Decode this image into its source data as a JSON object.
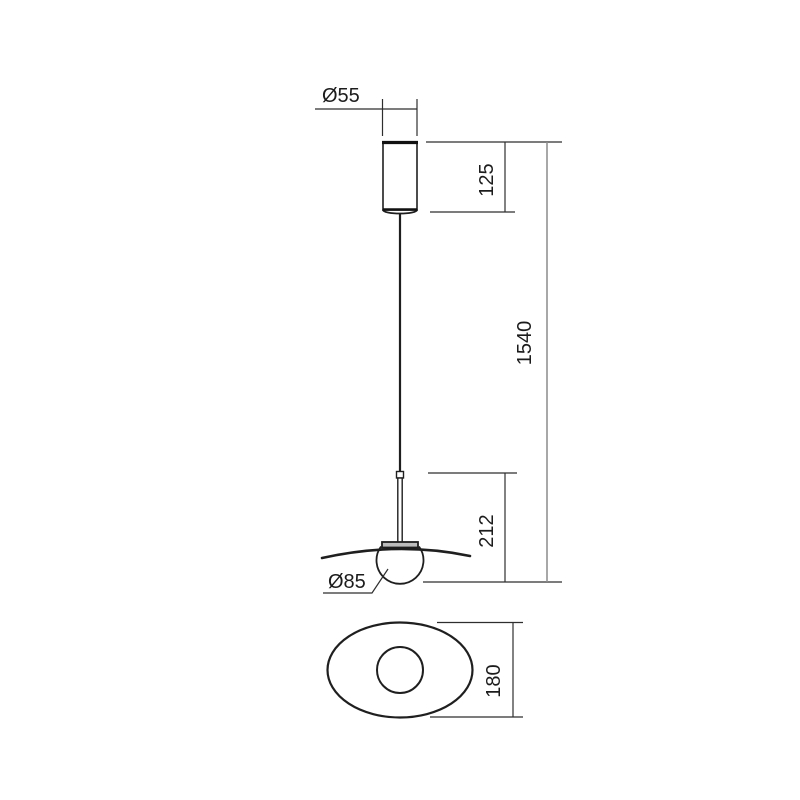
{
  "drawing": {
    "type": "technical-dimension-drawing",
    "subject": "pendant-lamp-front-and-bottom-view",
    "dimensions": {
      "canopy_diameter_label": "Ø55",
      "canopy_height_label": "125",
      "suspension_total_label": "1540",
      "head_height_label": "212",
      "sphere_diameter_label": "Ø85",
      "shade_depth_label": "180"
    },
    "colors": {
      "background": "#ffffff",
      "object_line": "#1f1f1f",
      "dimension_line": "#2e2e2e",
      "long_dimension_line": "#8c8c8c",
      "text": "#1c1c1c",
      "holder_fill": "#bdbdbd"
    }
  }
}
